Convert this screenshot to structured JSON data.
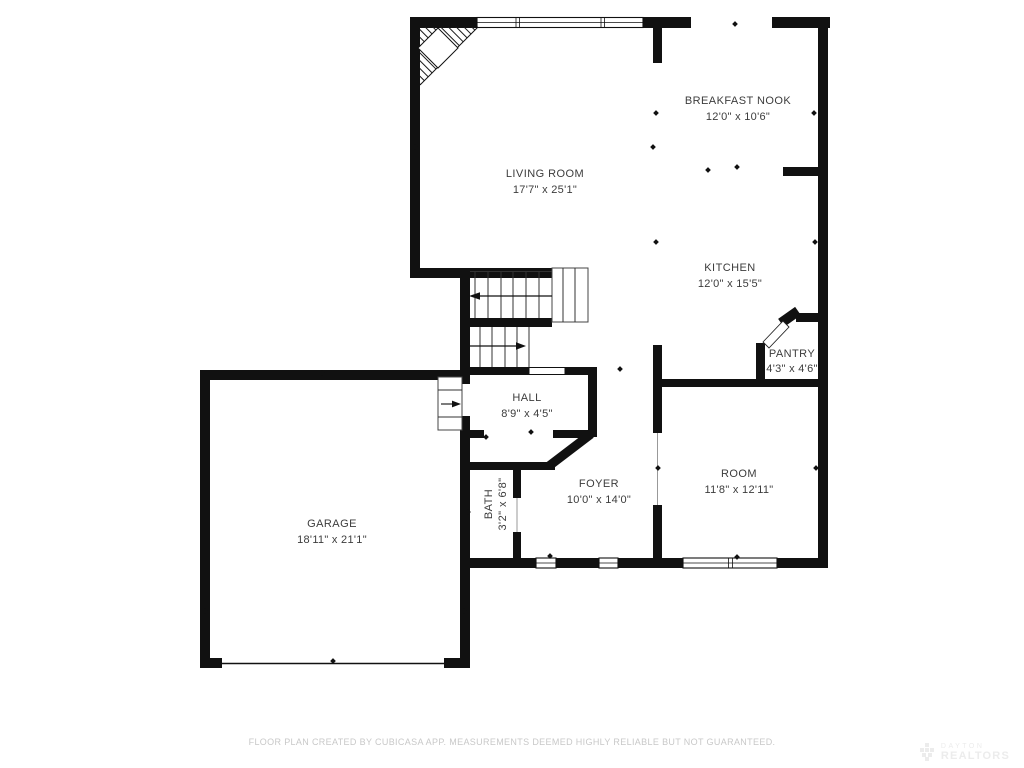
{
  "rooms": [
    {
      "name": "LIVING ROOM",
      "dims": "17'7\" x 25'1\""
    },
    {
      "name": "BREAKFAST NOOK",
      "dims": "12'0\" x 10'6\""
    },
    {
      "name": "KITCHEN",
      "dims": "12'0\" x 15'5\""
    },
    {
      "name": "PANTRY",
      "dims": "4'3\" x 4'6\""
    },
    {
      "name": "HALL",
      "dims": "8'9\" x 4'5\""
    },
    {
      "name": "FOYER",
      "dims": "10'0\" x 14'0\""
    },
    {
      "name": "ROOM",
      "dims": "11'8\" x 12'11\""
    },
    {
      "name": "BATH",
      "dims": "3'2\" x 6'8\""
    },
    {
      "name": "GARAGE",
      "dims": "18'11\" x 21'1\""
    }
  ],
  "footer": {
    "disclaimer": "FLOOR PLAN CREATED BY CUBICASA APP. MEASUREMENTS DEEMED HIGHLY RELIABLE BUT NOT GUARANTEED."
  },
  "watermark": {
    "line1": "DAYTON",
    "line2": "REALTORS"
  },
  "colors": {
    "wall": "#111111",
    "label": "#3c3c3c",
    "footer_text": "#c8c8c8",
    "watermark": "#ececec",
    "background": "#ffffff"
  }
}
